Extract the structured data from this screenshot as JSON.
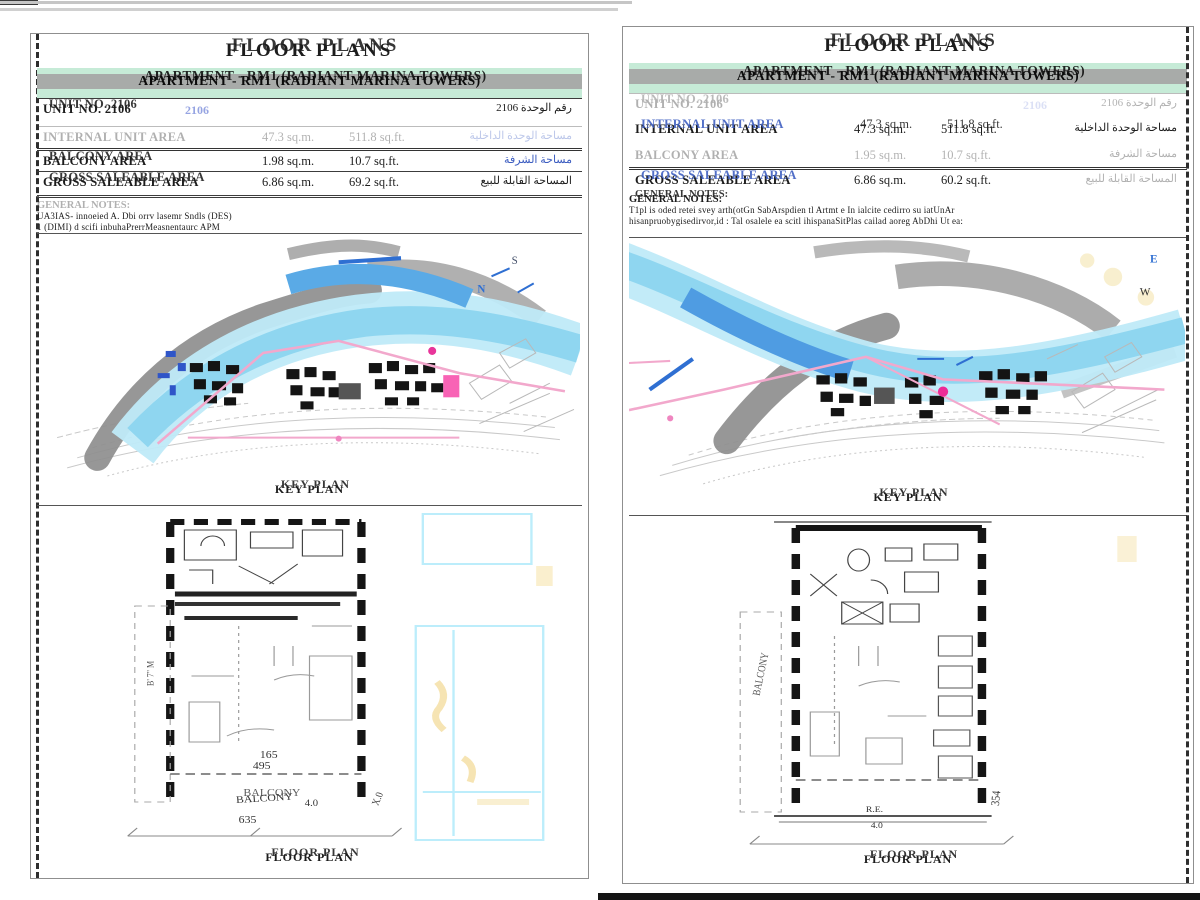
{
  "colors": {
    "water_light": "#bfeaf8",
    "water_mid": "#8fd6f0",
    "water_dark": "#5aaae6",
    "ink_blue": "#2f6fd2",
    "land_gray": "#8e8e8e",
    "route_pink": "#f2a8cc",
    "highlight_magenta": "#ec2b96",
    "banner_green": "#c6ebd7",
    "banner_gray": "#a5a5a5",
    "marker_yellow": "#f3dc9a"
  },
  "left_page": {
    "title": "FLOOR PLANS",
    "banner": "APARTMENT - RM1 (RADIANT MARINA TOWERS)",
    "unit_row": {
      "label": "UNIT NO. 2106",
      "ghost_number": "2106",
      "arabic": "رقم الوحدة 2106"
    },
    "rows": [
      {
        "label": "INTERNAL UNIT AREA",
        "metric": "47.3 sq.m.",
        "imperial": "511.8 sq.ft.",
        "arabic": "مساحة الوحدة الداخلية"
      },
      {
        "label": "BALCONY AREA",
        "metric": "1.98 sq.m.",
        "imperial": "10.7 sq.ft.",
        "arabic": "مساحة الشرفة"
      },
      {
        "label": "GROSS SALEABLE AREA",
        "metric": "6.86 sq.m.",
        "imperial": "69.2 sq.ft.",
        "arabic": "المساحة القابلة للبيع"
      }
    ],
    "notes_title": "GENERAL NOTES:",
    "notes": [
      "UA3IAS- innoeied A. Dbi orrv lasemr Sndls (DES)",
      "1 (DIMI) d scifi inbuhaPrerrMeasnentaurc APM"
    ],
    "key_plan_caption": "KEY PLAN",
    "floor_plan_caption": "FLOOR PLAN",
    "compass_s": "S",
    "compass_n": "N",
    "plan": {
      "side_label": "B' 7\" M",
      "dim_165": "165",
      "dim_495": "495",
      "balcony": "BALCONY",
      "dim_40": "4.0",
      "dim_635": "635",
      "dim_x0": "X.0"
    }
  },
  "right_page": {
    "title": "FLOOR PLANS",
    "banner": "APARTMENT - RM1 (RADIANT MARINA TOWERS)",
    "unit_row": {
      "label": "UNIT NO. 2106",
      "ghost_number": "2106",
      "arabic": "رقم الوحدة 2106"
    },
    "rows": [
      {
        "label": "INTERNAL UNIT AREA",
        "metric": "47.3 sq.m.",
        "imperial": "511.8 sq.ft.",
        "arabic": "مساحة الوحدة الداخلية"
      },
      {
        "label": "BALCONY AREA",
        "metric": "1.95 sq.m.",
        "imperial": "10.7 sq.ft.",
        "arabic": "مساحة الشرفة"
      },
      {
        "label": "GROSS SALEABLE AREA",
        "metric": "6.86 sq.m.",
        "imperial": "60.2 sq.ft.",
        "arabic": "المساحة القابلة للبيع"
      }
    ],
    "notes_title": "GENERAL NOTES:",
    "notes": [
      "T1pl is oded retei svey arth(otGn SabArspdien tl Artmt e In ialcite cedirro su iatUnAr",
      "hisanpruobygisedirvor,id : Tal osalele ea scitl ihispanaSitPlas cailad aoreg AbDhi Ut ea:"
    ],
    "key_plan_caption": "KEY PLAN",
    "floor_plan_caption": "FLOOR PLAN",
    "compass_e": "E",
    "compass_w": "W",
    "plan": {
      "balcony": "BALCONY",
      "re_label": "R.E.",
      "dim_40": "4.0",
      "dim_354": "354"
    }
  }
}
